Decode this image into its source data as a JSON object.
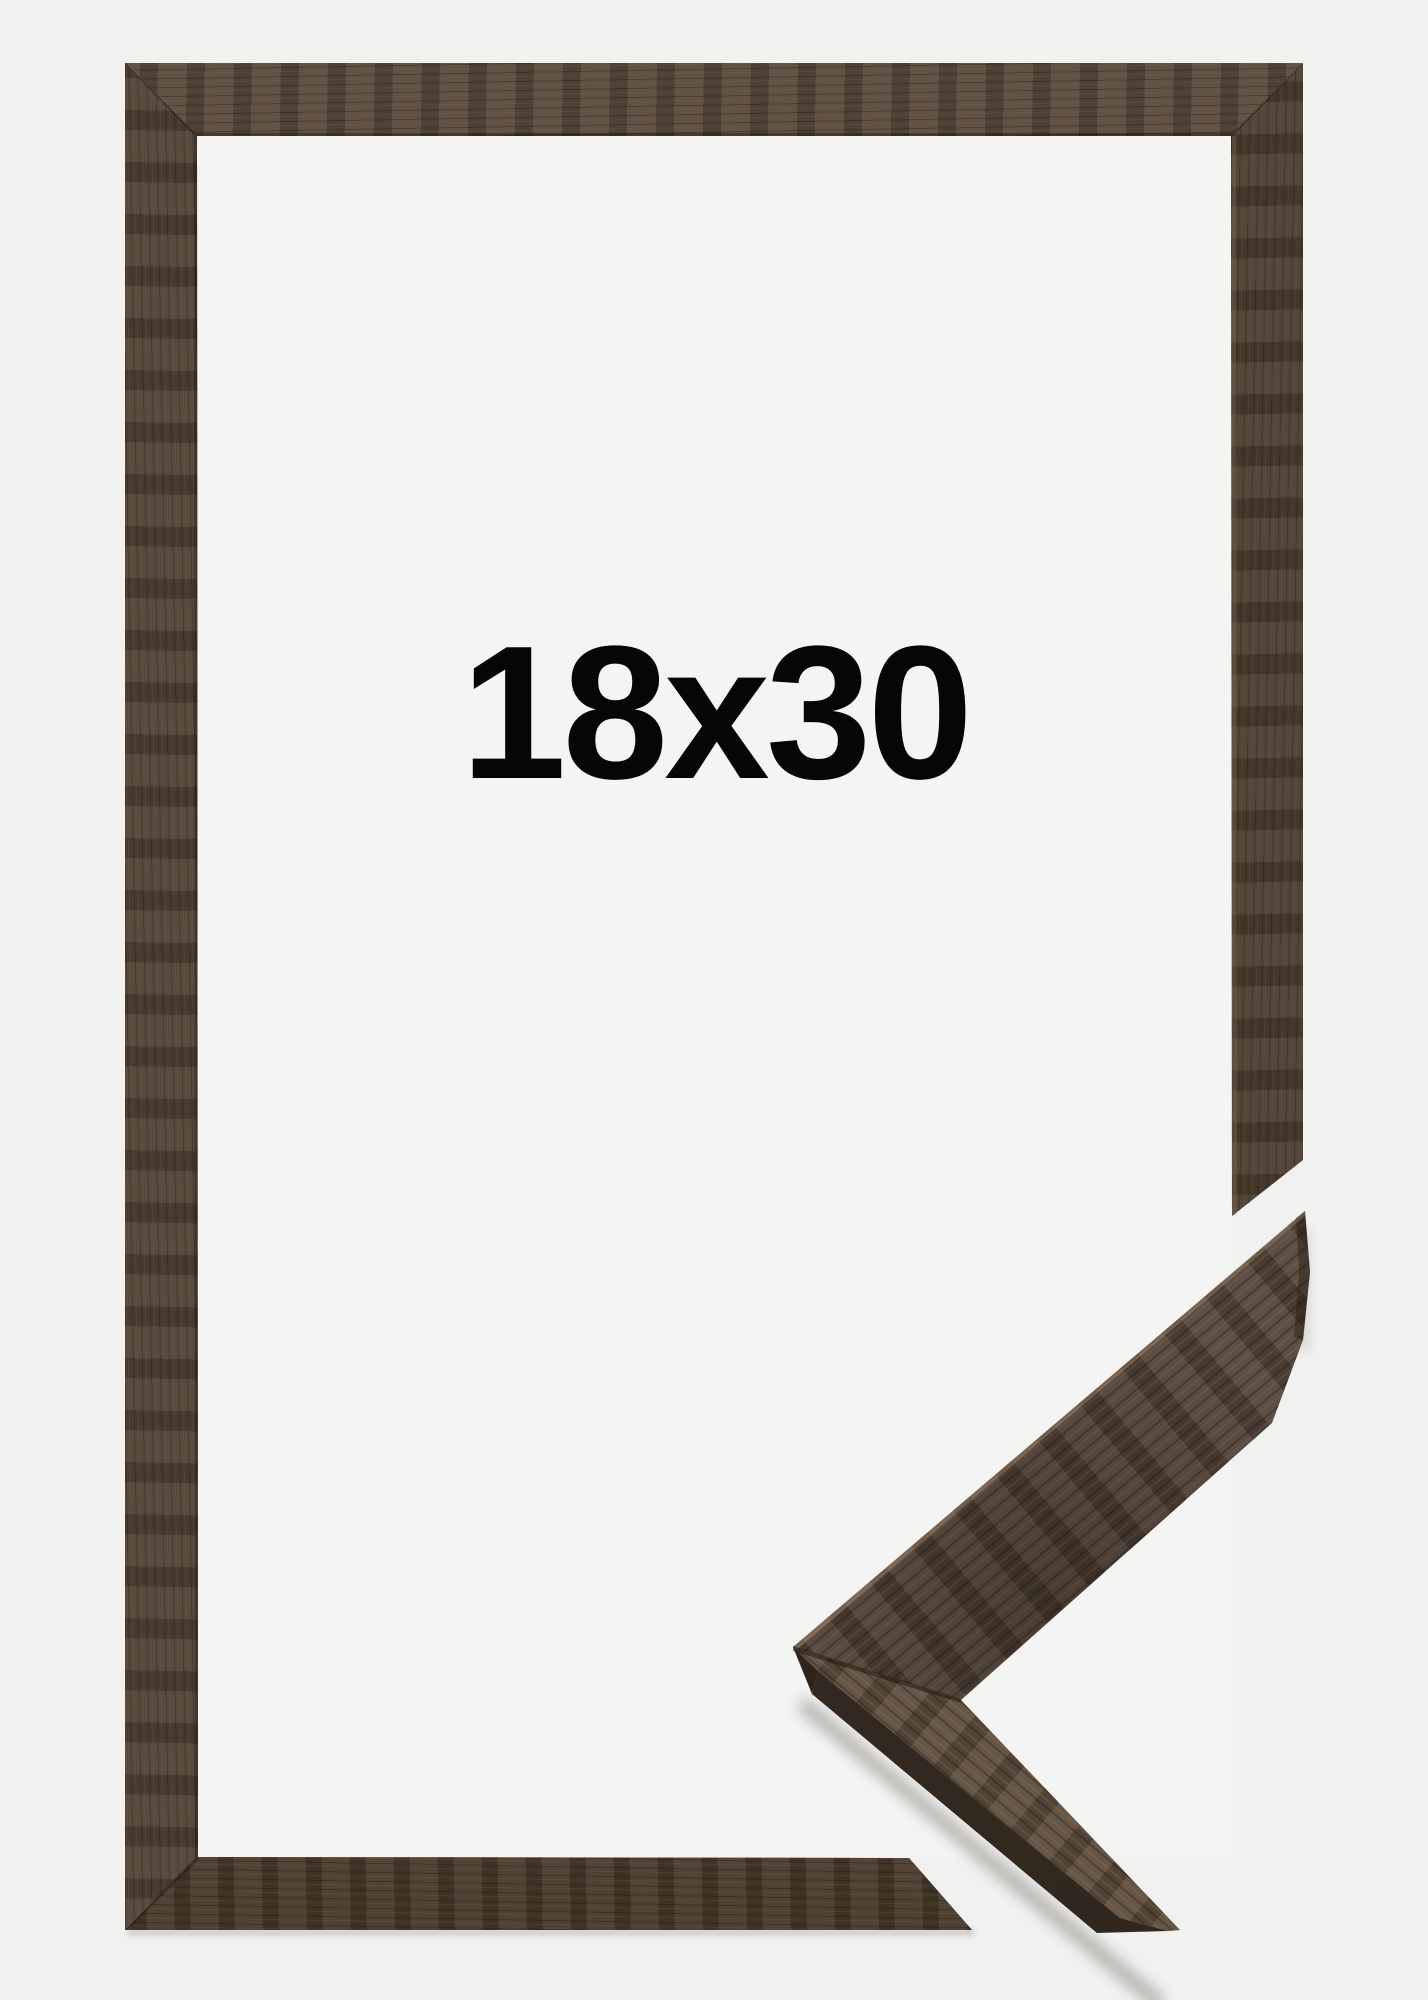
{
  "product_image": {
    "size_label": "18x30"
  },
  "colors": {
    "background": "#f1f1f0",
    "window": "#f4f4f3",
    "wood_base": "#4e4033",
    "wood_light": "#5d4d3e",
    "wood_dark": "#3a2f25",
    "wood_side_edge": "#332a21",
    "label_text": "#060606"
  }
}
